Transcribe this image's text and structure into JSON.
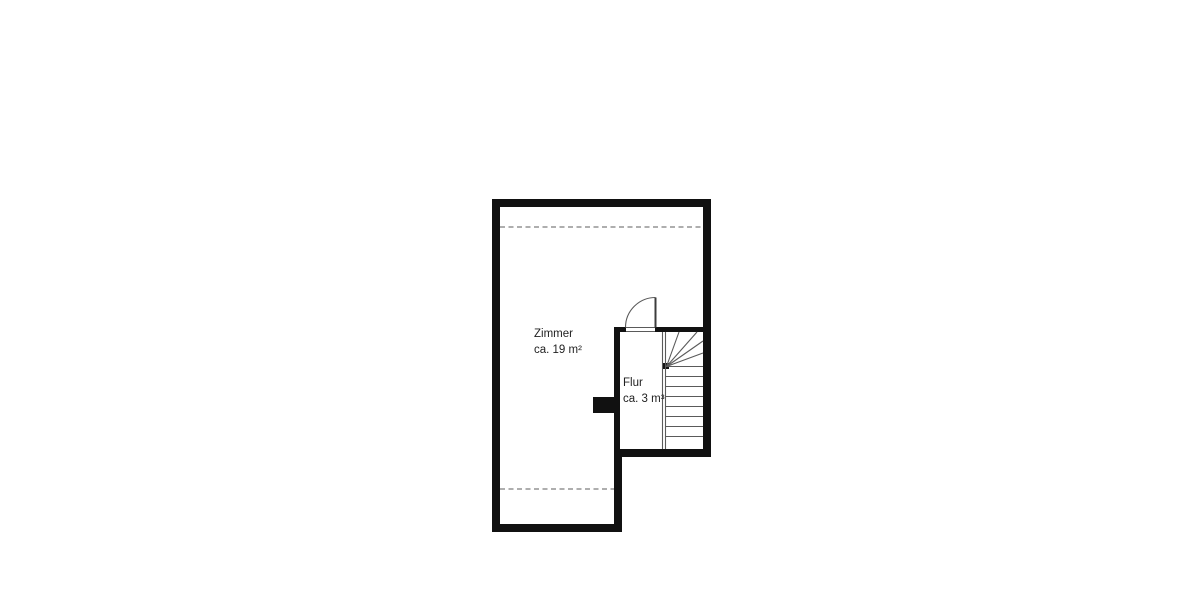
{
  "plan": {
    "type": "floor-plan",
    "rooms": [
      {
        "name": "Zimmer",
        "area": "ca. 19 m²"
      },
      {
        "name": "Flur",
        "area": "ca. 3 m³"
      }
    ],
    "stairs": {
      "straight_treads": 8,
      "winder_steps": 5
    },
    "colors": {
      "wall": "#111111",
      "thin_line": "#5a5a5a",
      "door_leaf": "#3c3c3c",
      "dashed_line": "#7d7d7d",
      "text": "#1f1f1f",
      "background": "#ffffff"
    }
  }
}
